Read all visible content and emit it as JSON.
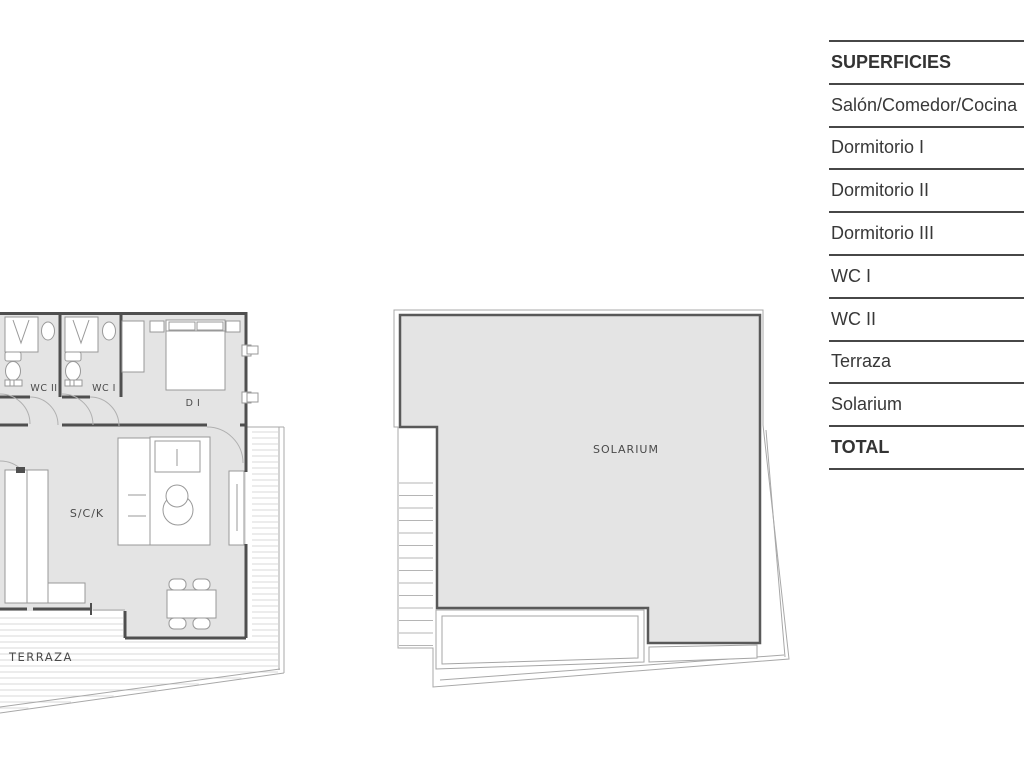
{
  "table": {
    "header": "SUPERFICIES",
    "rows": [
      {
        "label": "Salón/Comedor/Cocina",
        "bold": false
      },
      {
        "label": "Dormitorio I",
        "bold": false
      },
      {
        "label": "Dormitorio II",
        "bold": false
      },
      {
        "label": "Dormitorio III",
        "bold": false
      },
      {
        "label": "WC I",
        "bold": false
      },
      {
        "label": "WC II",
        "bold": false
      },
      {
        "label": "Terraza",
        "bold": false
      },
      {
        "label": "Solarium",
        "bold": false
      },
      {
        "label": "TOTAL",
        "bold": true
      }
    ]
  },
  "plans": {
    "apartment": {
      "wc2_label": "WC II",
      "wc1_label": "WC I",
      "bedroom_label": "D I",
      "living_label": "S/C/K",
      "terrace_label": "TERRAZA"
    },
    "solarium": {
      "label": "SOLARIUM"
    }
  },
  "colors": {
    "room_fill": "#e4e4e4",
    "wall": "#4f4f4f",
    "thin_line": "#a8a8a8",
    "hatch": "#dadada",
    "table_text": "#383838",
    "table_line": "#474747"
  }
}
